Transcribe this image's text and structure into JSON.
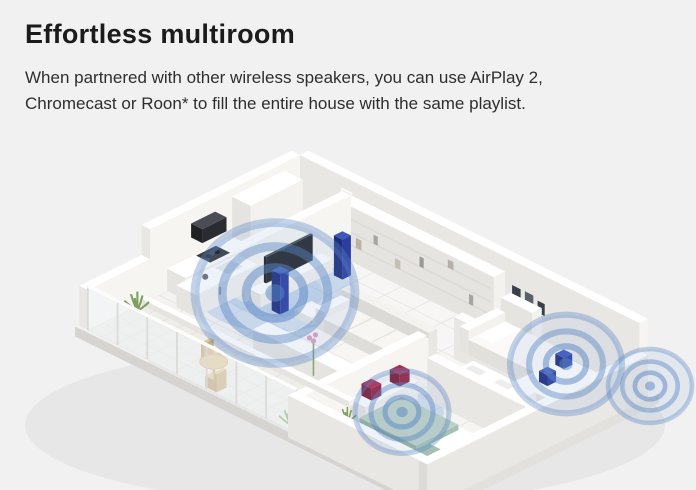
{
  "section": {
    "title": "Effortless multiroom",
    "body": "When partnered with other wireless speakers, you can use AirPlay 2,\nChromecast or Roon* to fill the entire house with the same playlist."
  },
  "illustration": {
    "label": "Isometric cutaway apartment with wireless speakers filling every room with music",
    "rooms": [
      "kitchen",
      "living-room",
      "balcony",
      "bedroom",
      "bathroom",
      "guest-room"
    ],
    "speaker_zones": 4
  },
  "colors": {
    "page_bg": "#f1f1f2",
    "heading_text": "#1b1b1b",
    "body_text": "#2e2e2e",
    "ring_blue": "#5886c4",
    "pool_blue": "#85aadd",
    "speaker_blue": "#2b3da0",
    "speaker_red": "#962041"
  }
}
